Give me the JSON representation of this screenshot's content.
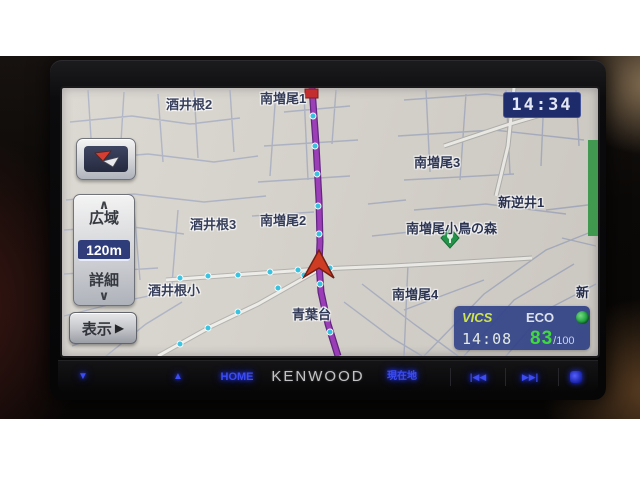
{
  "clock": {
    "time": "14:34"
  },
  "map": {
    "scale_value": "120m",
    "labels": [
      {
        "text": "酒井根2",
        "x": 104,
        "y": 6
      },
      {
        "text": "南増尾1",
        "x": 198,
        "y": 0
      },
      {
        "text": "南増尾3",
        "x": 352,
        "y": 64
      },
      {
        "text": "新逆井1",
        "x": 436,
        "y": 104
      },
      {
        "text": "酒井根3",
        "x": 128,
        "y": 126
      },
      {
        "text": "南増尾2",
        "x": 198,
        "y": 122
      },
      {
        "text": "南増尾小鳥の森",
        "x": 344,
        "y": 130
      },
      {
        "text": "酒井根小",
        "x": 86,
        "y": 192
      },
      {
        "text": "青葉台",
        "x": 230,
        "y": 216
      },
      {
        "text": "南増尾4",
        "x": 330,
        "y": 196
      },
      {
        "text": "新",
        "x": 514,
        "y": 194
      }
    ]
  },
  "controls": {
    "zoom_out_label": "広域",
    "zoom_in_label": "詳細",
    "display_label": "表示"
  },
  "status_panel": {
    "vics_label": "VICS",
    "vics_time": "14:08",
    "eco_label": "ECO",
    "eco_score": "83",
    "eco_denominator": "/100"
  },
  "bottom_bar": {
    "brand": "KENWOOD",
    "home_label": "HOME",
    "current_location_label": "現在地"
  },
  "icons": {
    "chevron_up": "∧",
    "chevron_down": "∨",
    "volume_down": "▼",
    "volume_up": "▲",
    "prev": "|◀◀",
    "next": "▶▶|",
    "display_arrow": "▶"
  },
  "colors": {
    "route_purple": "#9a35b8",
    "map_background": "#d8d4cd",
    "button_glow_blue": "#3c4cf0",
    "eco_green": "#41e541",
    "vics_yellow": "#d8ee4e"
  }
}
